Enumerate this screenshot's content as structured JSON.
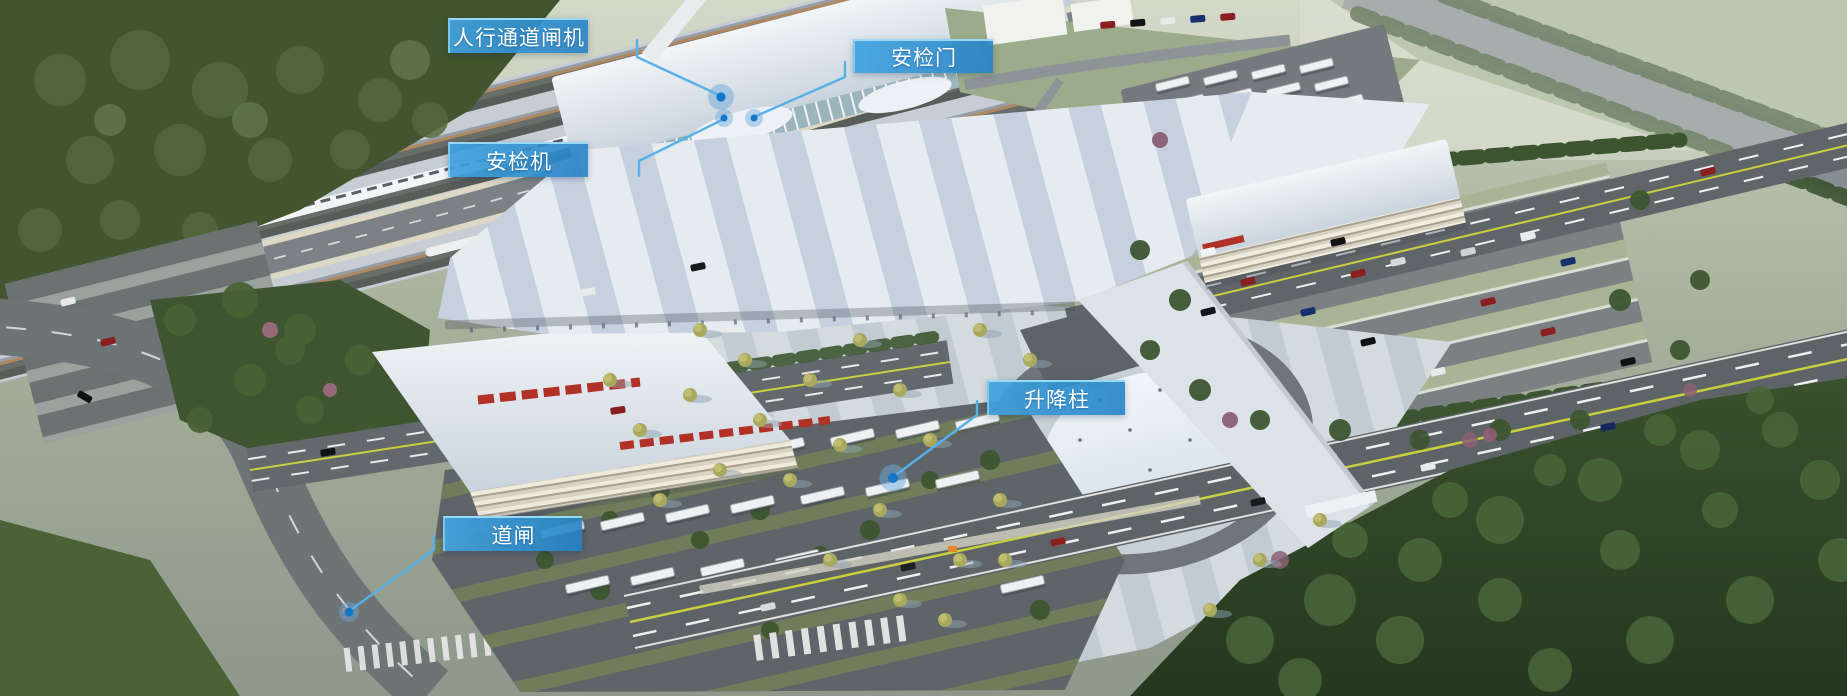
{
  "annotations": [
    {
      "id": "pedestrian-channel-gate",
      "label": "人行通道闸机"
    },
    {
      "id": "security-door",
      "label": "安检门"
    },
    {
      "id": "security-scanner",
      "label": "安检机"
    },
    {
      "id": "lifting-bollard",
      "label": "升降柱"
    },
    {
      "id": "barrier-gate",
      "label": "道闸"
    }
  ],
  "colors": {
    "label_background": "#2f8fd0",
    "label_highlight": "#8fd2f2",
    "leader_line": "#58b0e8",
    "marker_dot": "#1377c9"
  }
}
